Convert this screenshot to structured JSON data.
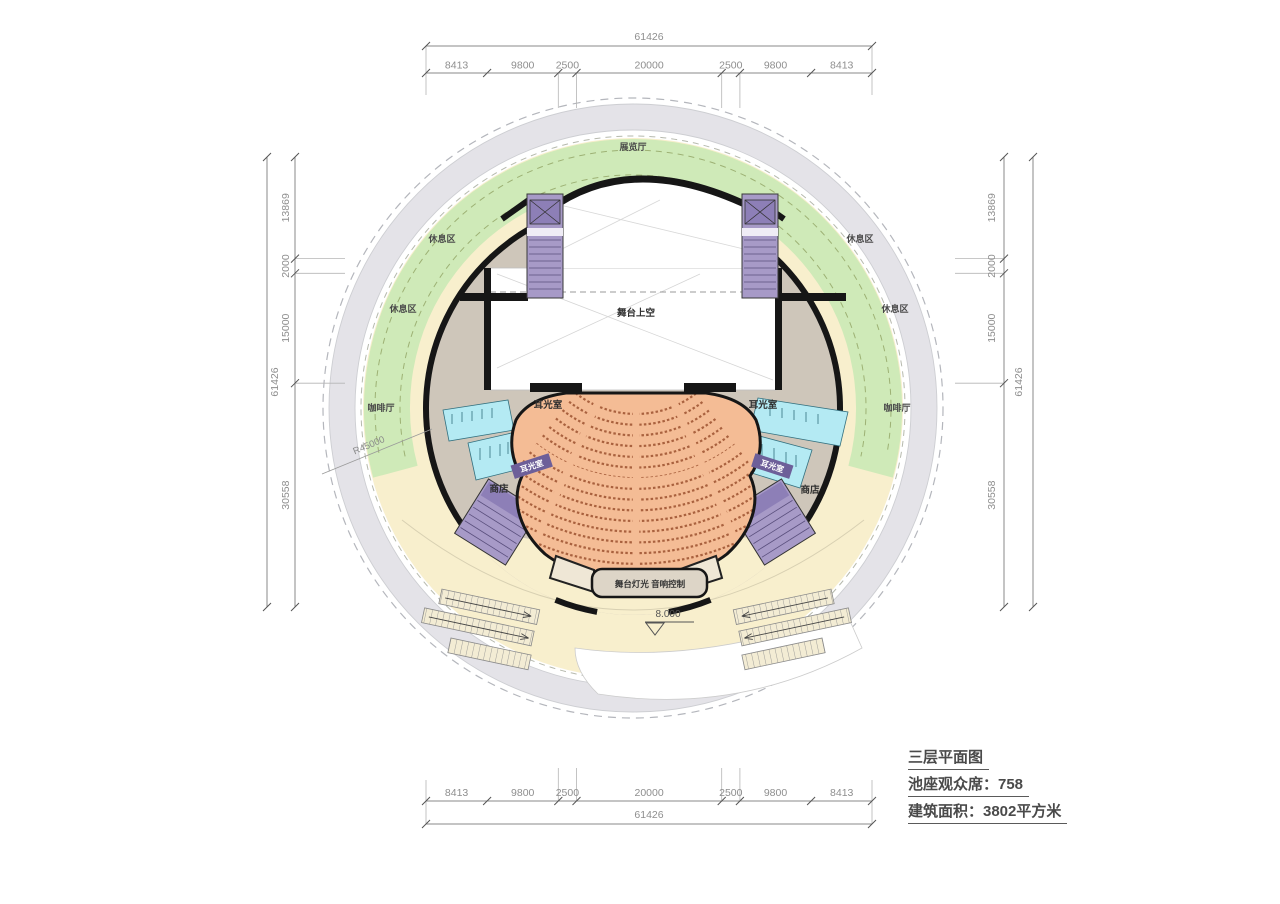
{
  "plan": {
    "title": "三层平面图",
    "seats": "池座观众席：758",
    "area": "建筑面积：3802平方米"
  },
  "labels": {
    "exhibition_hall": "展览厅",
    "rest_area": "休息区",
    "cafe": "咖啡厅",
    "stage_void": "舞台上空",
    "ear_light_room": "耳光室",
    "shop": "商店",
    "control_booth": "舞台灯光 音响控制",
    "elevation": "8.000",
    "radius": "R45000"
  },
  "dimensions": {
    "top": {
      "overall": "61426",
      "segments": [
        "8413",
        "9800",
        "2500",
        "20000",
        "2500",
        "9800",
        "8413"
      ]
    },
    "bottom": {
      "overall": "61426",
      "segments": [
        "8413",
        "9800",
        "2500",
        "20000",
        "2500",
        "9800",
        "8413"
      ]
    },
    "left": {
      "overall": "61426",
      "segments": [
        "13869",
        "2000",
        "15000",
        "30558"
      ]
    },
    "right": {
      "overall": "61426",
      "segments": [
        "13869",
        "2000",
        "15000",
        "30558"
      ]
    }
  },
  "colors": {
    "landscape_green": "#cfeab8",
    "plaza_cream": "#f8efcd",
    "corridor_gray": "#e4e3e8",
    "floor_taupe": "#cec6ba",
    "seating_salmon": "#f4bc95",
    "seat_row_brown": "#9c5230",
    "core_purple": "#a79ac7",
    "wc_cyan": "#b4eaf3",
    "wall_black": "#161616",
    "dim_text_gray": "#8e8e8e"
  }
}
